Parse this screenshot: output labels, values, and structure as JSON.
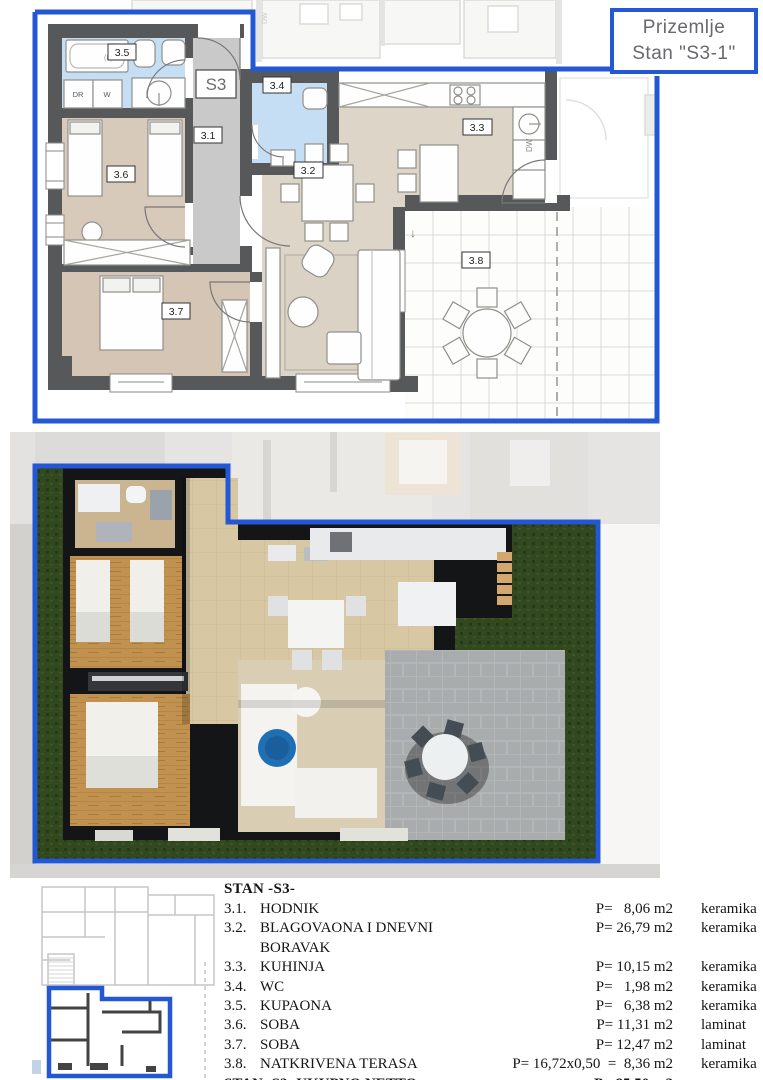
{
  "title_box": {
    "line1": "Prizemlje",
    "line2": "Stan \"S3-1\""
  },
  "plan2d": {
    "unit_label": "S3",
    "rooms": {
      "r31": "3.1",
      "r32": "3.2",
      "r33": "3.3",
      "r34": "3.4",
      "r35": "3.5",
      "r36": "3.6",
      "r37": "3.7",
      "r38": "3.8"
    },
    "appliances": {
      "dr": "DR",
      "w": "W",
      "dw": "DW"
    },
    "marks": {
      "tub": "(8)",
      "terrace_arrow": "↓"
    }
  },
  "colors": {
    "accent_blue": "#2357d4",
    "wall_gray": "#57585a",
    "bath_blue": "#c6def3",
    "corridor_gray": "#c9c9c9",
    "living_beige": "#dcd5c8",
    "bedroom_beige": "#d8cabb",
    "grass_green": "#32481f",
    "wood_floor": "#c1914f",
    "tile_beige": "#d8c7a3",
    "pavement_gray": "#a8acad"
  },
  "table": {
    "header": "STAN -S3-",
    "rows": [
      {
        "num": "3.1.",
        "name": "HODNIK",
        "area": "P=   8,06 m2",
        "material": "keramika"
      },
      {
        "num": "3.2.",
        "name": "BLAGOVAONA I DNEVNI BORAVAK",
        "area": "P= 26,79 m2",
        "material": "keramika"
      },
      {
        "num": "3.3.",
        "name": "KUHINJA",
        "area": "P= 10,15 m2",
        "material": "keramika"
      },
      {
        "num": "3.4.",
        "name": "WC",
        "area": "P=   1,98 m2",
        "material": "keramika"
      },
      {
        "num": "3.5.",
        "name": "KUPAONA",
        "area": "P=   6,38 m2",
        "material": "keramika"
      },
      {
        "num": "3.6.",
        "name": "SOBA",
        "area": "P= 11,31 m2",
        "material": "laminat"
      },
      {
        "num": "3.7.",
        "name": "SOBA",
        "area": "P= 12,47 m2",
        "material": "laminat"
      },
      {
        "num": "3.8.",
        "name": "NATKRIVENA TERASA",
        "area": "P= 16,72x0,50  =  8,36 m2",
        "material": "keramika"
      }
    ],
    "total": {
      "label": "STAN -S3- UKUPNO NETTO",
      "area": "P= 85,50 m2"
    }
  }
}
